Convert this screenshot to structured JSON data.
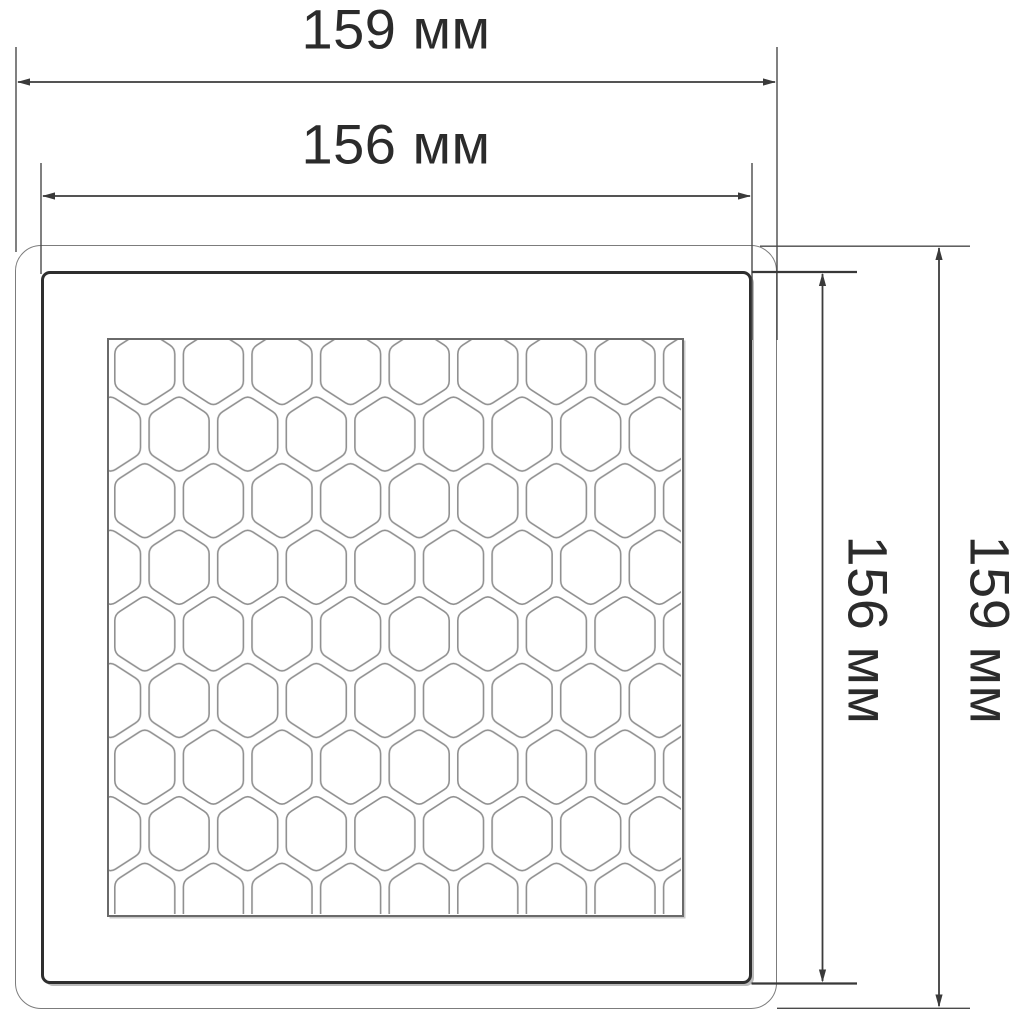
{
  "diagram": {
    "type": "technical-drawing",
    "subject": "square honeycomb panel, front view",
    "unit": "мм",
    "dimensions": [
      {
        "id": "outer-width",
        "value": "159",
        "label": "159 мм",
        "axis": "horizontal",
        "position": "top"
      },
      {
        "id": "inner-width",
        "value": "156",
        "label": "156 мм",
        "axis": "horizontal",
        "position": "top"
      },
      {
        "id": "inner-height",
        "value": "156",
        "label": "156 мм",
        "axis": "vertical",
        "position": "right"
      },
      {
        "id": "outer-height",
        "value": "159",
        "label": "159 мм",
        "axis": "vertical",
        "position": "right"
      }
    ],
    "colors": {
      "background": "#ffffff",
      "text": "#2b2b2b",
      "dimension_line": "#3c3c3c",
      "outer_frame": "#7c7c7c",
      "inner_frame": "#2e2e2e",
      "grid_border": "#6a6a6a",
      "hexagon_line": "#8f8f8f"
    }
  }
}
